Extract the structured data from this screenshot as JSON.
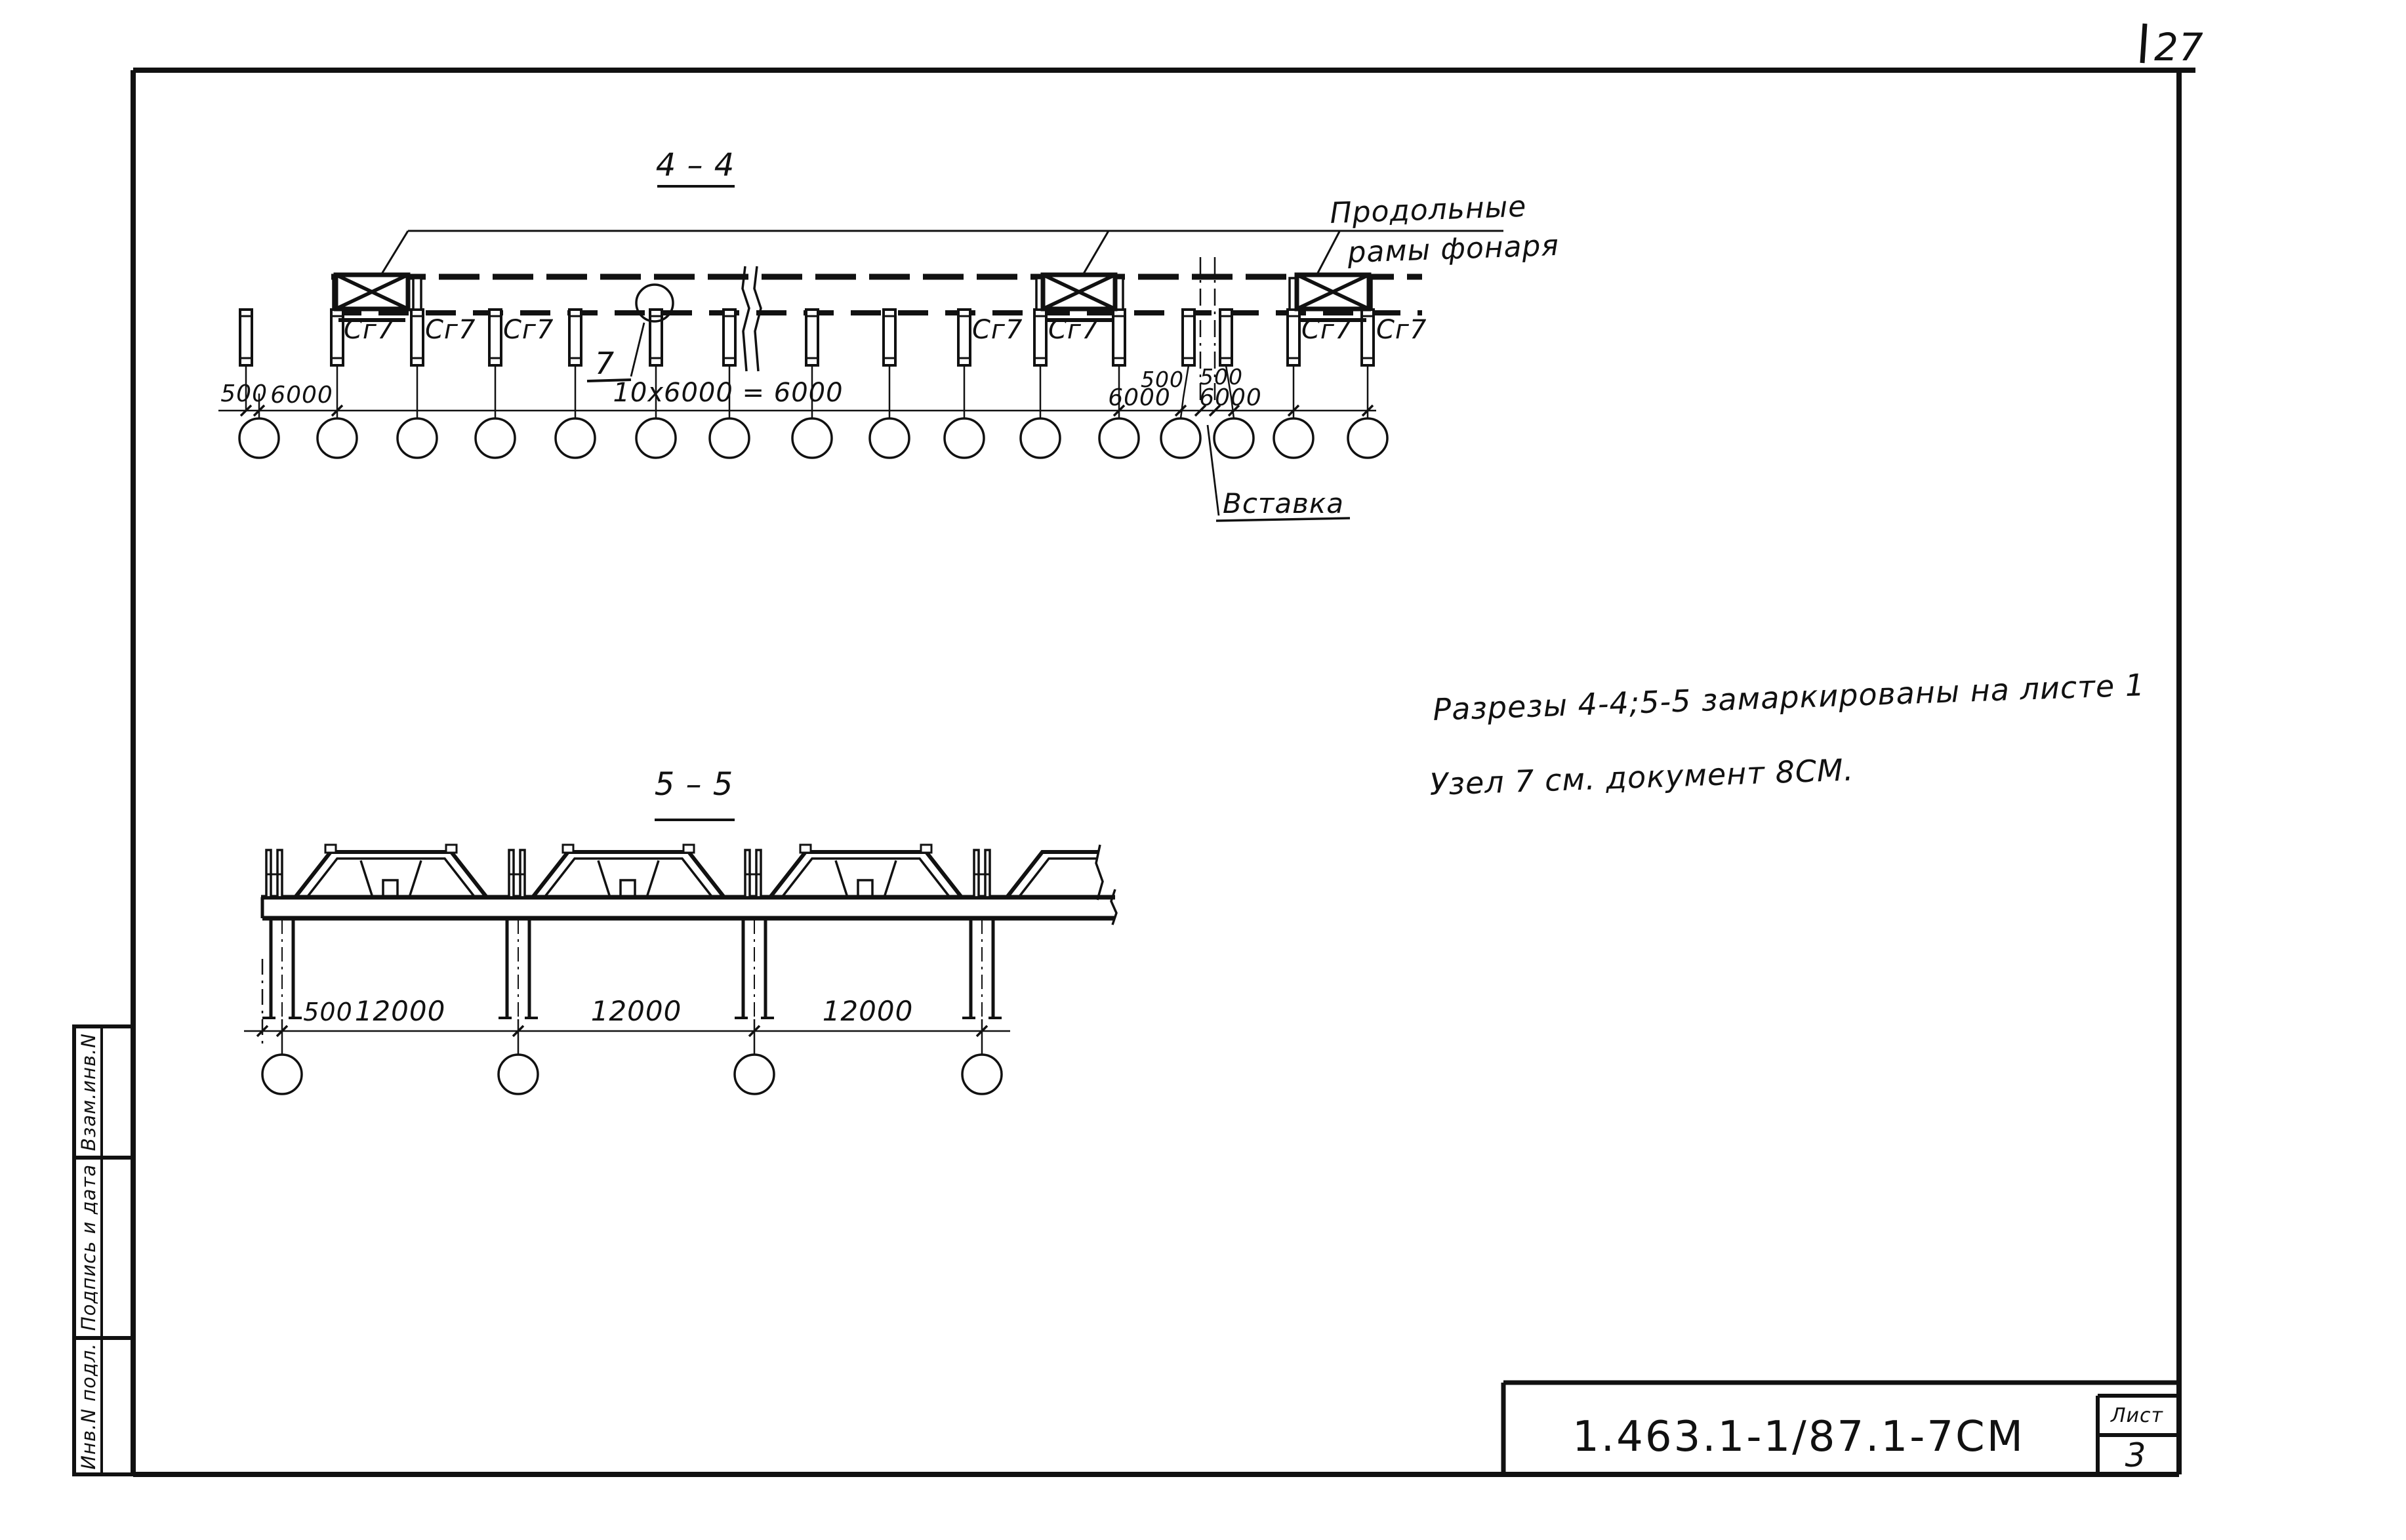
{
  "page": {
    "corner_number": "27"
  },
  "sidebar": {
    "boxes": [
      {
        "label": "Взам.инв.N"
      },
      {
        "label": "Подпись и дата"
      },
      {
        "label": "Инв.N подл."
      }
    ]
  },
  "title_block": {
    "designation": "1.463.1-1/87.1-7СМ",
    "sheet_label": "Лист",
    "sheet_number": "3"
  },
  "notes": {
    "line1": "Разрезы 4-4;5-5 замаркированы на листе 1",
    "line2": "Узел 7 см. документ 8СМ."
  },
  "section44": {
    "title": "4 – 4",
    "leader_label_line1": "Продольные",
    "leader_label_line2": "рамы фонаря",
    "frame_mark": "Сг7",
    "node_callout": "7",
    "insert_label": "Вставка",
    "dimensions": {
      "d500_left": "500",
      "d6000_left": "6000",
      "d_main": "10х6000 = 6000",
      "d6000_mid": "6000",
      "d500_a": "500",
      "d500_b": "500",
      "d6000_right": "6000"
    }
  },
  "section55": {
    "title": "5 – 5",
    "dimensions": {
      "d500": "500",
      "spans": [
        "12000",
        "12000",
        "12000"
      ]
    }
  }
}
